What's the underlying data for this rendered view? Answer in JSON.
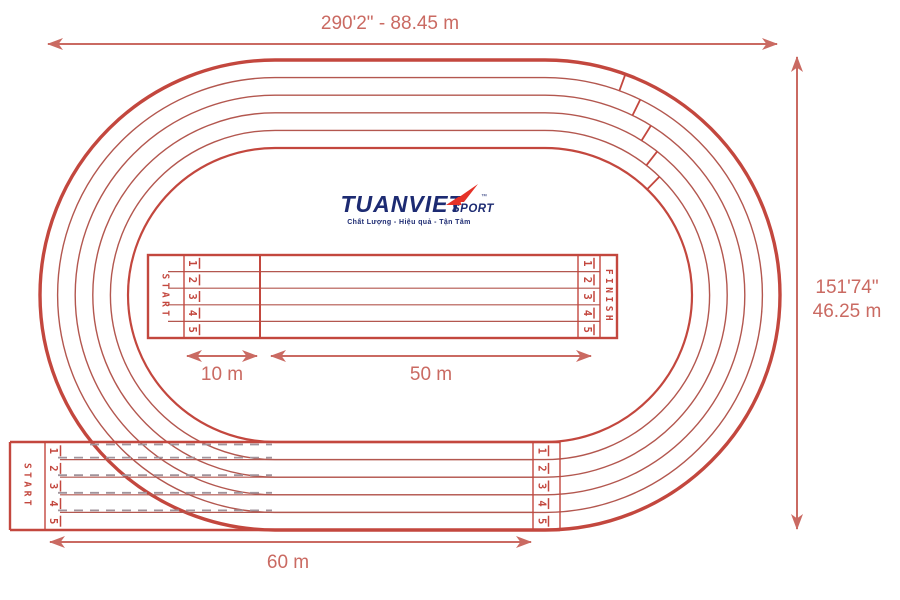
{
  "dimensions": {
    "top": "290'2\" - 88.45 m",
    "right_ft": "151'74\"",
    "right_m": "46.25 m",
    "straight_10m": "10 m",
    "straight_50m": "50 m",
    "straight_60m": "60 m"
  },
  "track": {
    "start_label": "START",
    "finish_label": "FINISH",
    "lane_numbers": [
      "1",
      "2",
      "3",
      "4",
      "5"
    ],
    "lane_count": 5
  },
  "logo": {
    "name": "TUANVIET",
    "sub": "SPORT",
    "tm": "™",
    "tagline": "Chất Lượng - Hiệu quả - Tận Tâm"
  },
  "colors": {
    "track_red": "#c3473e",
    "lane_red": "#b3574f",
    "dash_gray": "#a0949c",
    "dimension_red": "#ca6a62",
    "logo_navy": "#1d2b72",
    "logo_red": "#e53228"
  }
}
